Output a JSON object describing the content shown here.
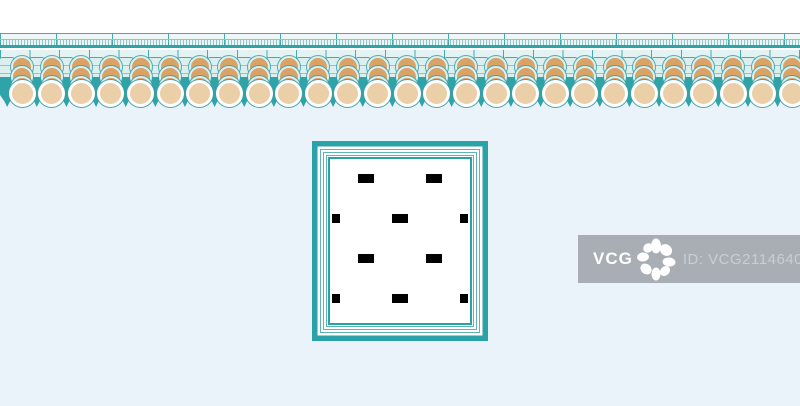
{
  "colors": {
    "teal": "#2EA3A8",
    "teal_line": "#45A9AD",
    "teal_soft": "#8FC6C9",
    "cyan_fill": "#DCEFEF",
    "cyan_pale": "#EDF7F7",
    "tan": "#D9A266",
    "beige": "#EBCFA8",
    "wall": "#EBF3FA",
    "wm_bg": "#A8AEB3",
    "wm_text": "#C9CED2"
  },
  "eave": {
    "unit_width": 29.63,
    "barrel_count": 28,
    "stack_count": 27
  },
  "watermark": {
    "brand": "VCG",
    "id_text": "ID: VCG211464026927"
  }
}
